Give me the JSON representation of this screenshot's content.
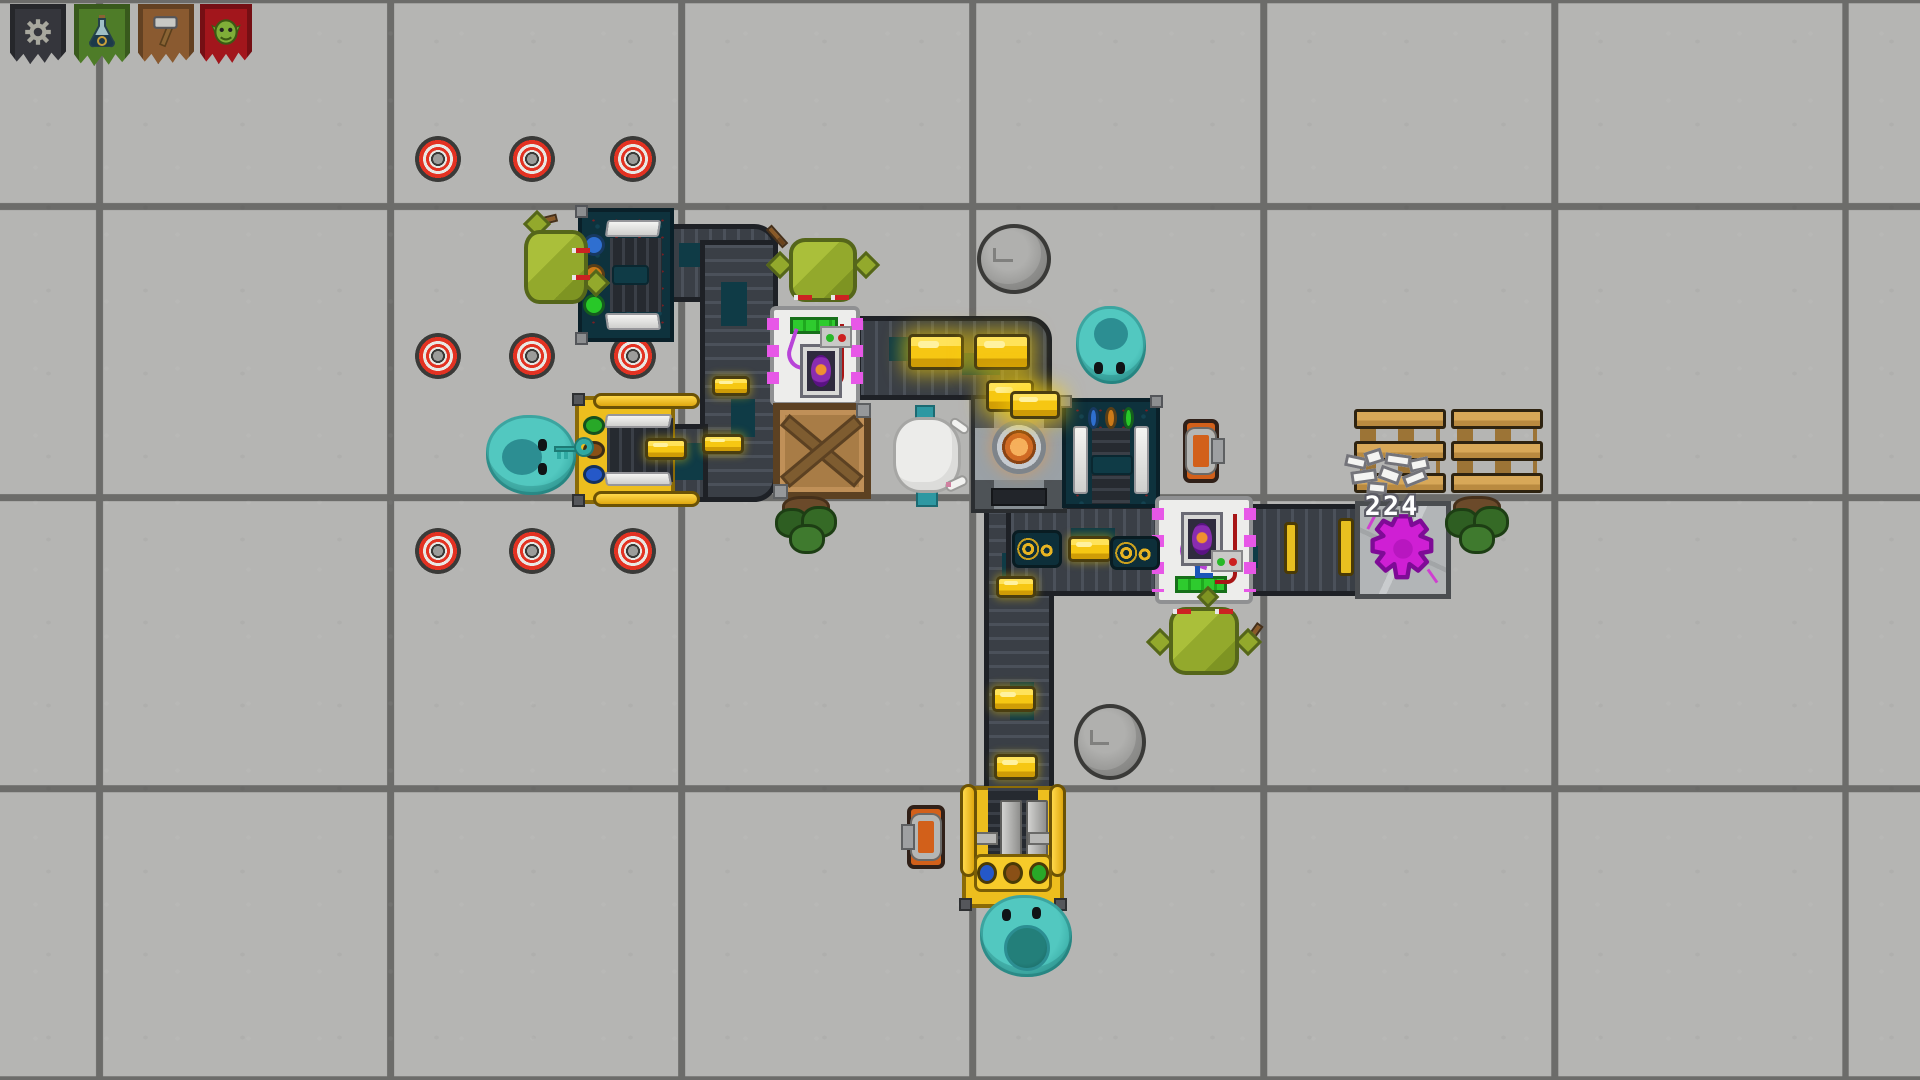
{
  "scene": {
    "width": 1920,
    "height": 1080,
    "floor": {
      "tile_color": "#b5b5b3",
      "grid_line_color": "#6c6c6a",
      "tile_size": 291,
      "grid_offset_x": 96,
      "grid_offset_y": 203
    },
    "palette": {
      "belt_dark": "#3a3f46",
      "belt_plate_teal": "#0f3b46",
      "gold": "#f6c713",
      "machine_teal": "#0e323d",
      "machine_yellow": "#edbe1e",
      "assembler_white": "#ededeb",
      "assembler_pins_magenta": "#e757e7",
      "progress_green": "#2ecb2e",
      "furnace_gray": "#4e5357",
      "ember_orange": "#d06a24",
      "crate_brown": "#a87c46",
      "pallet_wood": "#d8a858",
      "platform_purple": "#cf1fd4",
      "goblin_green": "#93a92c",
      "slime_teal": "#36a8a2",
      "mine_red": "#e33222",
      "toolbox_orange": "#d2601a"
    }
  },
  "labels": {
    "stack_count": "224"
  },
  "entities": [
    {
      "type": "mine",
      "name": "target-mine",
      "x": 415,
      "y": 136,
      "w": 46,
      "h": 46,
      "interactable": true
    },
    {
      "type": "mine",
      "name": "target-mine",
      "x": 509,
      "y": 136,
      "w": 46,
      "h": 46,
      "interactable": true
    },
    {
      "type": "mine",
      "name": "target-mine",
      "x": 610,
      "y": 136,
      "w": 46,
      "h": 46,
      "interactable": true
    },
    {
      "type": "mine",
      "name": "target-mine",
      "x": 415,
      "y": 333,
      "w": 46,
      "h": 46,
      "interactable": true
    },
    {
      "type": "mine",
      "name": "target-mine",
      "x": 509,
      "y": 333,
      "w": 46,
      "h": 46,
      "interactable": true
    },
    {
      "type": "mine",
      "name": "target-mine",
      "x": 610,
      "y": 333,
      "w": 46,
      "h": 46,
      "interactable": true
    },
    {
      "type": "mine",
      "name": "target-mine",
      "x": 415,
      "y": 528,
      "w": 46,
      "h": 46,
      "interactable": true
    },
    {
      "type": "mine",
      "name": "target-mine",
      "x": 509,
      "y": 528,
      "w": 46,
      "h": 46,
      "interactable": true
    },
    {
      "type": "mine",
      "name": "target-mine",
      "x": 610,
      "y": 528,
      "w": 46,
      "h": 46,
      "interactable": true
    },
    {
      "type": "belt",
      "name": "conveyor-belt",
      "x": 662,
      "y": 224,
      "w": 116,
      "h": 78,
      "orient": "h",
      "corners": "tr",
      "interactable": true
    },
    {
      "type": "belt",
      "name": "conveyor-belt",
      "x": 700,
      "y": 240,
      "w": 78,
      "h": 262,
      "orient": "v",
      "corners": "br",
      "interactable": true
    },
    {
      "type": "belt",
      "name": "conveyor-belt",
      "x": 664,
      "y": 424,
      "w": 44,
      "h": 78,
      "orient": "h",
      "interactable": true
    },
    {
      "type": "belt",
      "name": "conveyor-belt",
      "x": 856,
      "y": 316,
      "w": 196,
      "h": 84,
      "orient": "h",
      "corners": "tr",
      "interactable": true
    },
    {
      "type": "belt",
      "name": "conveyor-belt",
      "x": 984,
      "y": 506,
      "w": 70,
      "h": 286,
      "orient": "v",
      "interactable": true
    },
    {
      "type": "belt",
      "name": "conveyor-belt",
      "x": 1006,
      "y": 504,
      "w": 356,
      "h": 92,
      "orient": "h",
      "interactable": true
    },
    {
      "type": "belt-clamp",
      "name": "belt-clamp",
      "x": 1284,
      "y": 522,
      "w": 14,
      "h": 52,
      "interactable": false
    },
    {
      "type": "belt-clamp",
      "name": "belt-clamp",
      "x": 1338,
      "y": 518,
      "w": 16,
      "h": 58,
      "interactable": false
    },
    {
      "type": "extractor",
      "name": "extractor-machine",
      "x": 578,
      "y": 208,
      "w": 96,
      "h": 134,
      "dots": [
        "#2f6fd0",
        "#cc7a18",
        "#28c828"
      ],
      "interactable": true
    },
    {
      "type": "loader",
      "name": "loader-machine",
      "x": 575,
      "y": 396,
      "w": 100,
      "h": 108,
      "dots": [
        "#28a828",
        "#8a5016",
        "#2558c8"
      ],
      "interactable": true
    },
    {
      "type": "furnace",
      "name": "stone-furnace",
      "x": 971,
      "y": 395,
      "w": 96,
      "h": 118,
      "interactable": true
    },
    {
      "type": "unloader",
      "name": "unloader-machine",
      "x": 1062,
      "y": 398,
      "w": 98,
      "h": 110,
      "dots": [
        "#2f6fd0",
        "#cc7a18",
        "#28c828"
      ],
      "interactable": true
    },
    {
      "type": "assembler",
      "name": "assembler-machine",
      "x": 770,
      "y": 306,
      "w": 90,
      "h": 100,
      "variant": "a",
      "interactable": true
    },
    {
      "type": "assembler",
      "name": "assembler-machine",
      "x": 1155,
      "y": 496,
      "w": 98,
      "h": 108,
      "variant": "b",
      "interactable": true
    },
    {
      "type": "press",
      "name": "press-machine",
      "x": 962,
      "y": 786,
      "w": 102,
      "h": 122,
      "dots": [
        "#2558c8",
        "#8a5016",
        "#28a828"
      ],
      "interactable": true
    },
    {
      "type": "platform",
      "name": "summoning-platform",
      "x": 1355,
      "y": 501,
      "w": 96,
      "h": 98,
      "interactable": true
    },
    {
      "type": "crate",
      "name": "wooden-crate",
      "x": 773,
      "y": 403,
      "w": 98,
      "h": 96,
      "interactable": true
    },
    {
      "type": "pallet",
      "name": "wooden-pallet",
      "x": 1354,
      "y": 409,
      "w": 92,
      "h": 88,
      "interactable": true
    },
    {
      "type": "pallet",
      "name": "wooden-pallet",
      "x": 1451,
      "y": 409,
      "w": 92,
      "h": 88,
      "interactable": true
    },
    {
      "type": "pile",
      "name": "item-stack",
      "x": 1341,
      "y": 448,
      "w": 102,
      "h": 66,
      "label": "224",
      "interactable": true
    },
    {
      "type": "toolbox",
      "name": "toolbox-item",
      "x": 1183,
      "y": 419,
      "w": 36,
      "h": 64,
      "variant": "tab-right",
      "interactable": true
    },
    {
      "type": "toolbox",
      "name": "toolbox-item",
      "x": 907,
      "y": 805,
      "w": 38,
      "h": 64,
      "variant": "tab-left",
      "interactable": true
    },
    {
      "type": "gold",
      "name": "gold-bar",
      "x": 712,
      "y": 376,
      "w": 38,
      "h": 20,
      "interactable": true
    },
    {
      "type": "gold",
      "name": "gold-bar",
      "x": 702,
      "y": 434,
      "w": 42,
      "h": 20,
      "interactable": true
    },
    {
      "type": "gold",
      "name": "gold-bar",
      "x": 645,
      "y": 438,
      "w": 42,
      "h": 22,
      "interactable": true
    },
    {
      "type": "gold",
      "name": "gold-bar",
      "x": 908,
      "y": 334,
      "w": 56,
      "h": 36,
      "variant": "glow",
      "interactable": true
    },
    {
      "type": "gold",
      "name": "gold-bar",
      "x": 974,
      "y": 334,
      "w": 56,
      "h": 36,
      "variant": "glow",
      "interactable": true
    },
    {
      "type": "gold",
      "name": "gold-bar",
      "x": 986,
      "y": 380,
      "w": 48,
      "h": 32,
      "variant": "glow",
      "interactable": true
    },
    {
      "type": "gold",
      "name": "gold-bar",
      "x": 1010,
      "y": 391,
      "w": 50,
      "h": 28,
      "variant": "glow",
      "interactable": true
    },
    {
      "type": "gold",
      "name": "gold-bar",
      "x": 996,
      "y": 576,
      "w": 40,
      "h": 22,
      "interactable": true
    },
    {
      "type": "gold",
      "name": "gold-bar",
      "x": 992,
      "y": 686,
      "w": 44,
      "h": 26,
      "interactable": true
    },
    {
      "type": "gold",
      "name": "gold-bar",
      "x": 994,
      "y": 754,
      "w": 44,
      "h": 26,
      "interactable": true
    },
    {
      "type": "gold",
      "name": "gold-bar",
      "x": 1068,
      "y": 536,
      "w": 44,
      "h": 26,
      "interactable": true
    },
    {
      "type": "goldswirl",
      "name": "gilded-plate",
      "x": 1012,
      "y": 530,
      "w": 50,
      "h": 38,
      "interactable": true
    },
    {
      "type": "goldswirl",
      "name": "gilded-plate",
      "x": 1110,
      "y": 536,
      "w": 50,
      "h": 34,
      "interactable": true
    },
    {
      "type": "bush",
      "name": "bush",
      "x": 775,
      "y": 492,
      "w": 62,
      "h": 70,
      "interactable": true
    },
    {
      "type": "bush",
      "name": "bush",
      "x": 1445,
      "y": 492,
      "w": 64,
      "h": 68,
      "interactable": true
    },
    {
      "type": "rock",
      "name": "boulder",
      "x": 977,
      "y": 224,
      "w": 74,
      "h": 70,
      "interactable": true
    },
    {
      "type": "rock",
      "name": "boulder",
      "x": 1074,
      "y": 704,
      "w": 72,
      "h": 76,
      "interactable": true
    },
    {
      "type": "goblin",
      "name": "goblin",
      "x": 514,
      "y": 220,
      "w": 84,
      "h": 94,
      "facing": "right",
      "interactable": true
    },
    {
      "type": "goblin",
      "name": "goblin",
      "x": 779,
      "y": 228,
      "w": 88,
      "h": 84,
      "facing": "down",
      "interactable": true
    },
    {
      "type": "goblin",
      "name": "goblin",
      "x": 1159,
      "y": 597,
      "w": 90,
      "h": 88,
      "facing": "up",
      "interactable": true
    },
    {
      "type": "slime",
      "name": "slime",
      "x": 484,
      "y": 413,
      "w": 94,
      "h": 84,
      "variant": "key",
      "interactable": true
    },
    {
      "type": "slime",
      "name": "slime",
      "x": 1074,
      "y": 304,
      "w": 74,
      "h": 82,
      "variant": "down",
      "interactable": true
    },
    {
      "type": "slime",
      "name": "slime",
      "x": 978,
      "y": 893,
      "w": 96,
      "h": 86,
      "variant": "mouth",
      "interactable": true
    },
    {
      "type": "sheep",
      "name": "sheep",
      "x": 889,
      "y": 407,
      "w": 76,
      "h": 98,
      "interactable": true
    },
    {
      "type": "banner-gear",
      "name": "banner-gear",
      "x": 10,
      "y": 4,
      "w": 56,
      "h": 64,
      "interactable": true
    },
    {
      "type": "banner-flask",
      "name": "banner-flask",
      "x": 74,
      "y": 4,
      "w": 56,
      "h": 66,
      "interactable": true
    },
    {
      "type": "banner-hammer",
      "name": "banner-hammer",
      "x": 138,
      "y": 4,
      "w": 56,
      "h": 64,
      "interactable": true
    },
    {
      "type": "banner-goblin",
      "name": "banner-goblin",
      "x": 200,
      "y": 4,
      "w": 52,
      "h": 64,
      "interactable": true
    }
  ]
}
